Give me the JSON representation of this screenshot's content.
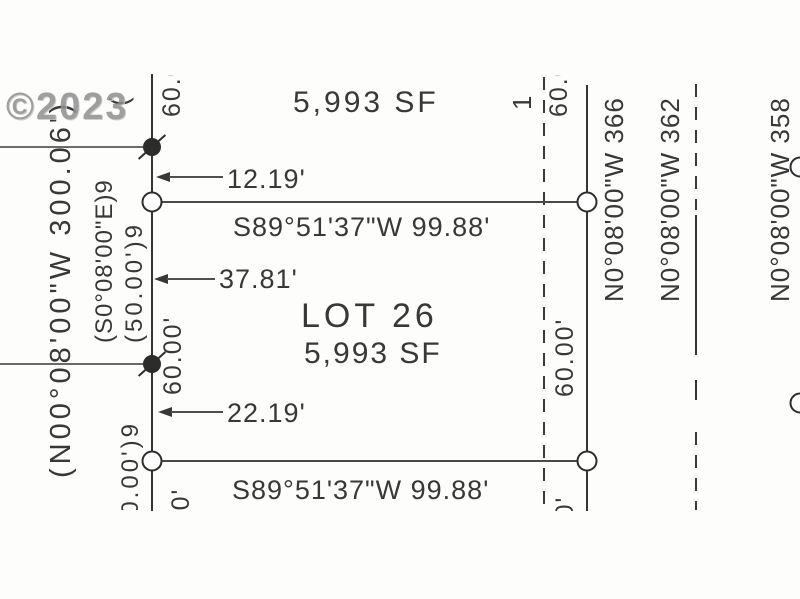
{
  "watermark": "©2023",
  "colors": {
    "ink": "#3a3a3a",
    "ink_light": "#6a6a6a",
    "watermark_gray": "#8f8f8f",
    "paper": "#fdfdfc"
  },
  "lot": {
    "name": "LOT 26",
    "area": "5,993 SF"
  },
  "north_lot_area": "5,993 SF",
  "bearings": {
    "north_line": "S89°51'37\"W  99.88'",
    "south_line": "S89°51'37\"W  99.88'",
    "west_line": "(N00°08'00\"W 300.06')",
    "west_record_bearing": "(S0°08'00\"E)9",
    "west_record_distance": "(50.00')9",
    "west_record_distance_south": "(50.00')9"
  },
  "offset_dims": {
    "north": "12.19'",
    "middle": "37.81'",
    "south": "22.19'"
  },
  "frontages": {
    "west": "60.00'",
    "east": "60.00'",
    "west_north_stub": "60.00'",
    "east_north_stub": "60.00'",
    "west_south_stub": "60.00'",
    "east_south_stub": "60.00'"
  },
  "east_lots": [
    {
      "label": "N0°08'00\"W 366"
    },
    {
      "label": "N0°08'00\"W 362"
    },
    {
      "label": "N0°08'00\"W 358"
    }
  ],
  "edge_marks": {
    "top_tick": "1",
    "top_paren": "("
  }
}
